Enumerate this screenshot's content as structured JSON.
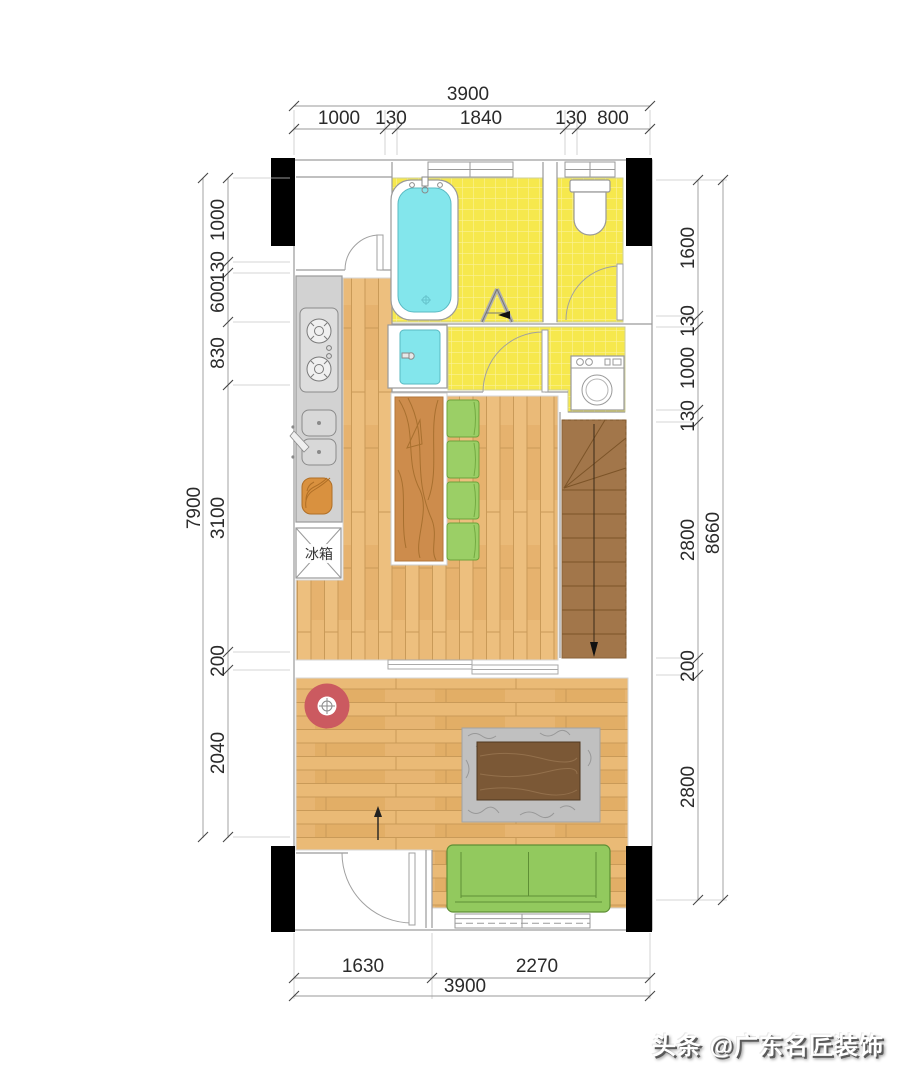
{
  "watermark": "头条 @广东名匠装饰",
  "labels": {
    "fridge": "冰箱"
  },
  "dims": {
    "top": {
      "total": "3900",
      "segments": [
        "1000",
        "130",
        "1840",
        "130",
        "800"
      ]
    },
    "bottom": {
      "total": "3900",
      "segments": [
        "1630",
        "2270"
      ]
    },
    "left": {
      "total": "7900",
      "segments": [
        "1000",
        "130",
        "600",
        "830",
        "3100",
        "200",
        "2040"
      ]
    },
    "right": {
      "total": "8660",
      "segments": [
        "1600",
        "130",
        "1000",
        "130",
        "2800",
        "200",
        "2800"
      ]
    }
  },
  "colors": {
    "tile_yellow": "#f6e84d",
    "water_cyan": "#83e6ec",
    "wood_floor": "#edbf7e",
    "table_wood": "#cd8c4c",
    "stairs_wood": "#a2764a",
    "walnut_dark": "#7b5836",
    "furniture_green": "#92c95e",
    "accent_red": "#cb5a60",
    "wall_black": "#000000",
    "counter_gray": "#d2d2d2",
    "rug_gray": "#c0c0c0"
  }
}
